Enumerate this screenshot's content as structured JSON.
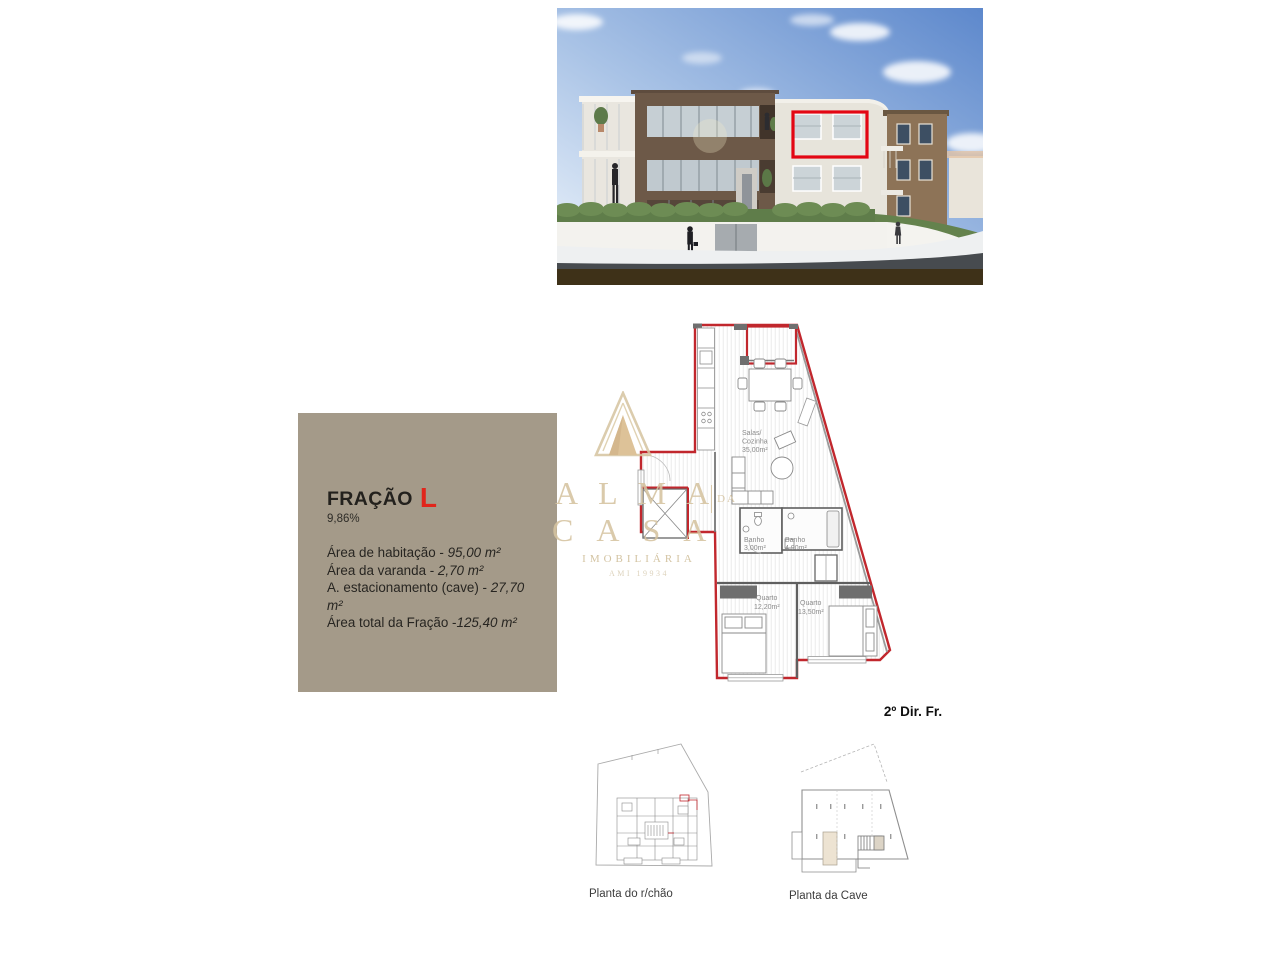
{
  "page": {
    "background": "#ffffff"
  },
  "info_panel": {
    "title": "FRAÇÃO",
    "fraction_letter": "L",
    "percentage": "9,86%",
    "areas": [
      {
        "label": "Área de habitação - ",
        "value": "95,00 m²"
      },
      {
        "label": "Área da varanda - ",
        "value": "2,70 m²"
      },
      {
        "label": "A. estacionamento (cave) - ",
        "value": "27,70 m²"
      },
      {
        "label": "Área total da Fração -",
        "value": "125,40 m²"
      }
    ],
    "colors": {
      "background": "#a49a89",
      "text": "#272521",
      "accent": "#e1251b"
    }
  },
  "watermark": {
    "brand_top": "ALMA",
    "brand_link": "DA",
    "brand_bottom": "CASA",
    "subtitle": "IMOBILIÁRIA",
    "license": "AMI 19934",
    "color": "#d5c3a0"
  },
  "building_render": {
    "description": "3D exterior render of apartment block with unit highlighted",
    "highlight_color": "#e30613"
  },
  "floor_plan": {
    "unit_label": "2º Dir. Fr.",
    "wall_color": "#c1272d",
    "rooms": {
      "living": {
        "line1": "Salas/",
        "line2": "Cozinha",
        "area": "35,00m²"
      },
      "bath1": {
        "name": "Banho",
        "area": "3,00m²"
      },
      "bath2": {
        "name": "Banho",
        "area": "4,90m²"
      },
      "bed1": {
        "name": "Quarto",
        "area": "12,20m²"
      },
      "bed2": {
        "name": "Quarto",
        "area": "13,50m²"
      }
    }
  },
  "mini_plans": {
    "ground": {
      "caption": "Planta do r/chão"
    },
    "basement": {
      "caption": "Planta da Cave"
    }
  }
}
